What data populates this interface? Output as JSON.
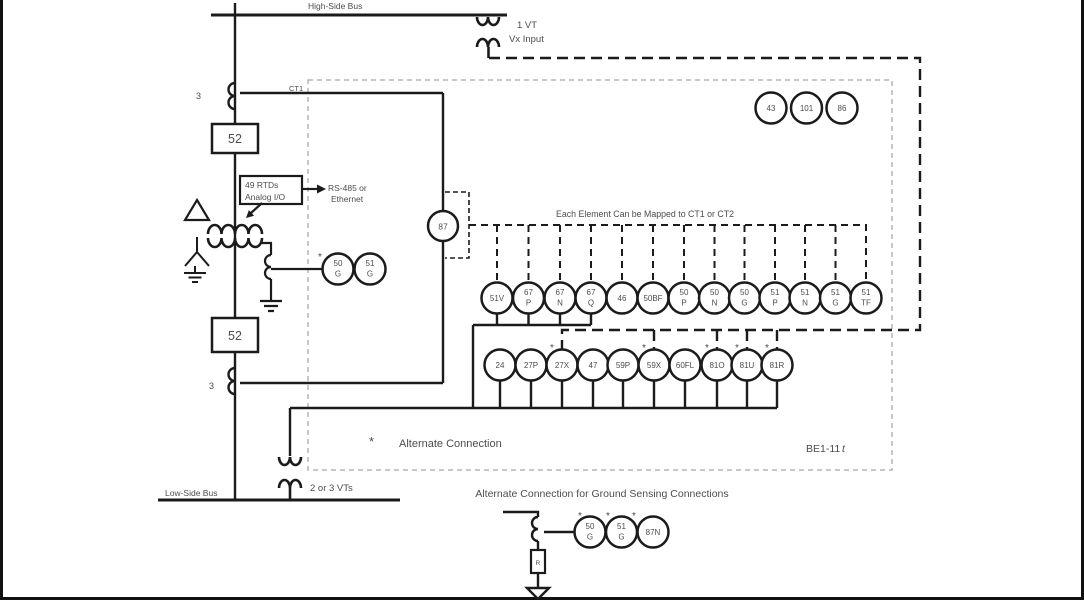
{
  "buses": {
    "high": "High-Side Bus",
    "low": "Low-Side Bus"
  },
  "feeder": {
    "breaker_top": "52",
    "breaker_bottom": "52",
    "ct1_label": "CT1",
    "ct_count_top": "3",
    "ct_count_bottom": "3"
  },
  "vt_top": {
    "line1": "1 VT",
    "line2": "Vx Input"
  },
  "vt_bottom": {
    "label": "2 or 3 VTs"
  },
  "rtd": {
    "line1": "49 RTDs",
    "line2": "Analog I/O",
    "comm_line1": "RS-485 or",
    "comm_line2": "Ethernet"
  },
  "device": {
    "name": "BE1-11",
    "suffix": "t"
  },
  "notes": {
    "mapped": "Each Element Can be Mapped to CT1 or CT2",
    "alt_marker": "*",
    "alt": "Alternate Connection",
    "ground_title": "Alternate Connection for Ground Sensing Connections"
  },
  "elements": {
    "control": [
      "43",
      "101",
      "86"
    ],
    "diff": "87",
    "row1": [
      [
        "51V"
      ],
      [
        "67",
        "P"
      ],
      [
        "67",
        "N"
      ],
      [
        "67",
        "Q"
      ],
      [
        "46"
      ],
      [
        "50BF"
      ],
      [
        "50",
        "P"
      ],
      [
        "50",
        "N"
      ],
      [
        "50",
        "G"
      ],
      [
        "51",
        "P"
      ],
      [
        "51",
        "N"
      ],
      [
        "51",
        "G"
      ],
      [
        "51",
        "TF"
      ]
    ],
    "row2": [
      "24",
      "27P",
      "27X",
      "47",
      "59P",
      "59X",
      "60FL",
      "81O",
      "81U",
      "81R"
    ],
    "neutral": [
      [
        "50",
        "G"
      ],
      [
        "51",
        "G"
      ]
    ],
    "ground": [
      [
        "50",
        "G"
      ],
      [
        "51",
        "G"
      ],
      [
        "87N"
      ]
    ],
    "asterisk": "*",
    "resistor": "R"
  },
  "colors": {
    "line": "#1b1b1b",
    "text": "#4d4d4d",
    "gray_dash": "#b5b5b5"
  }
}
